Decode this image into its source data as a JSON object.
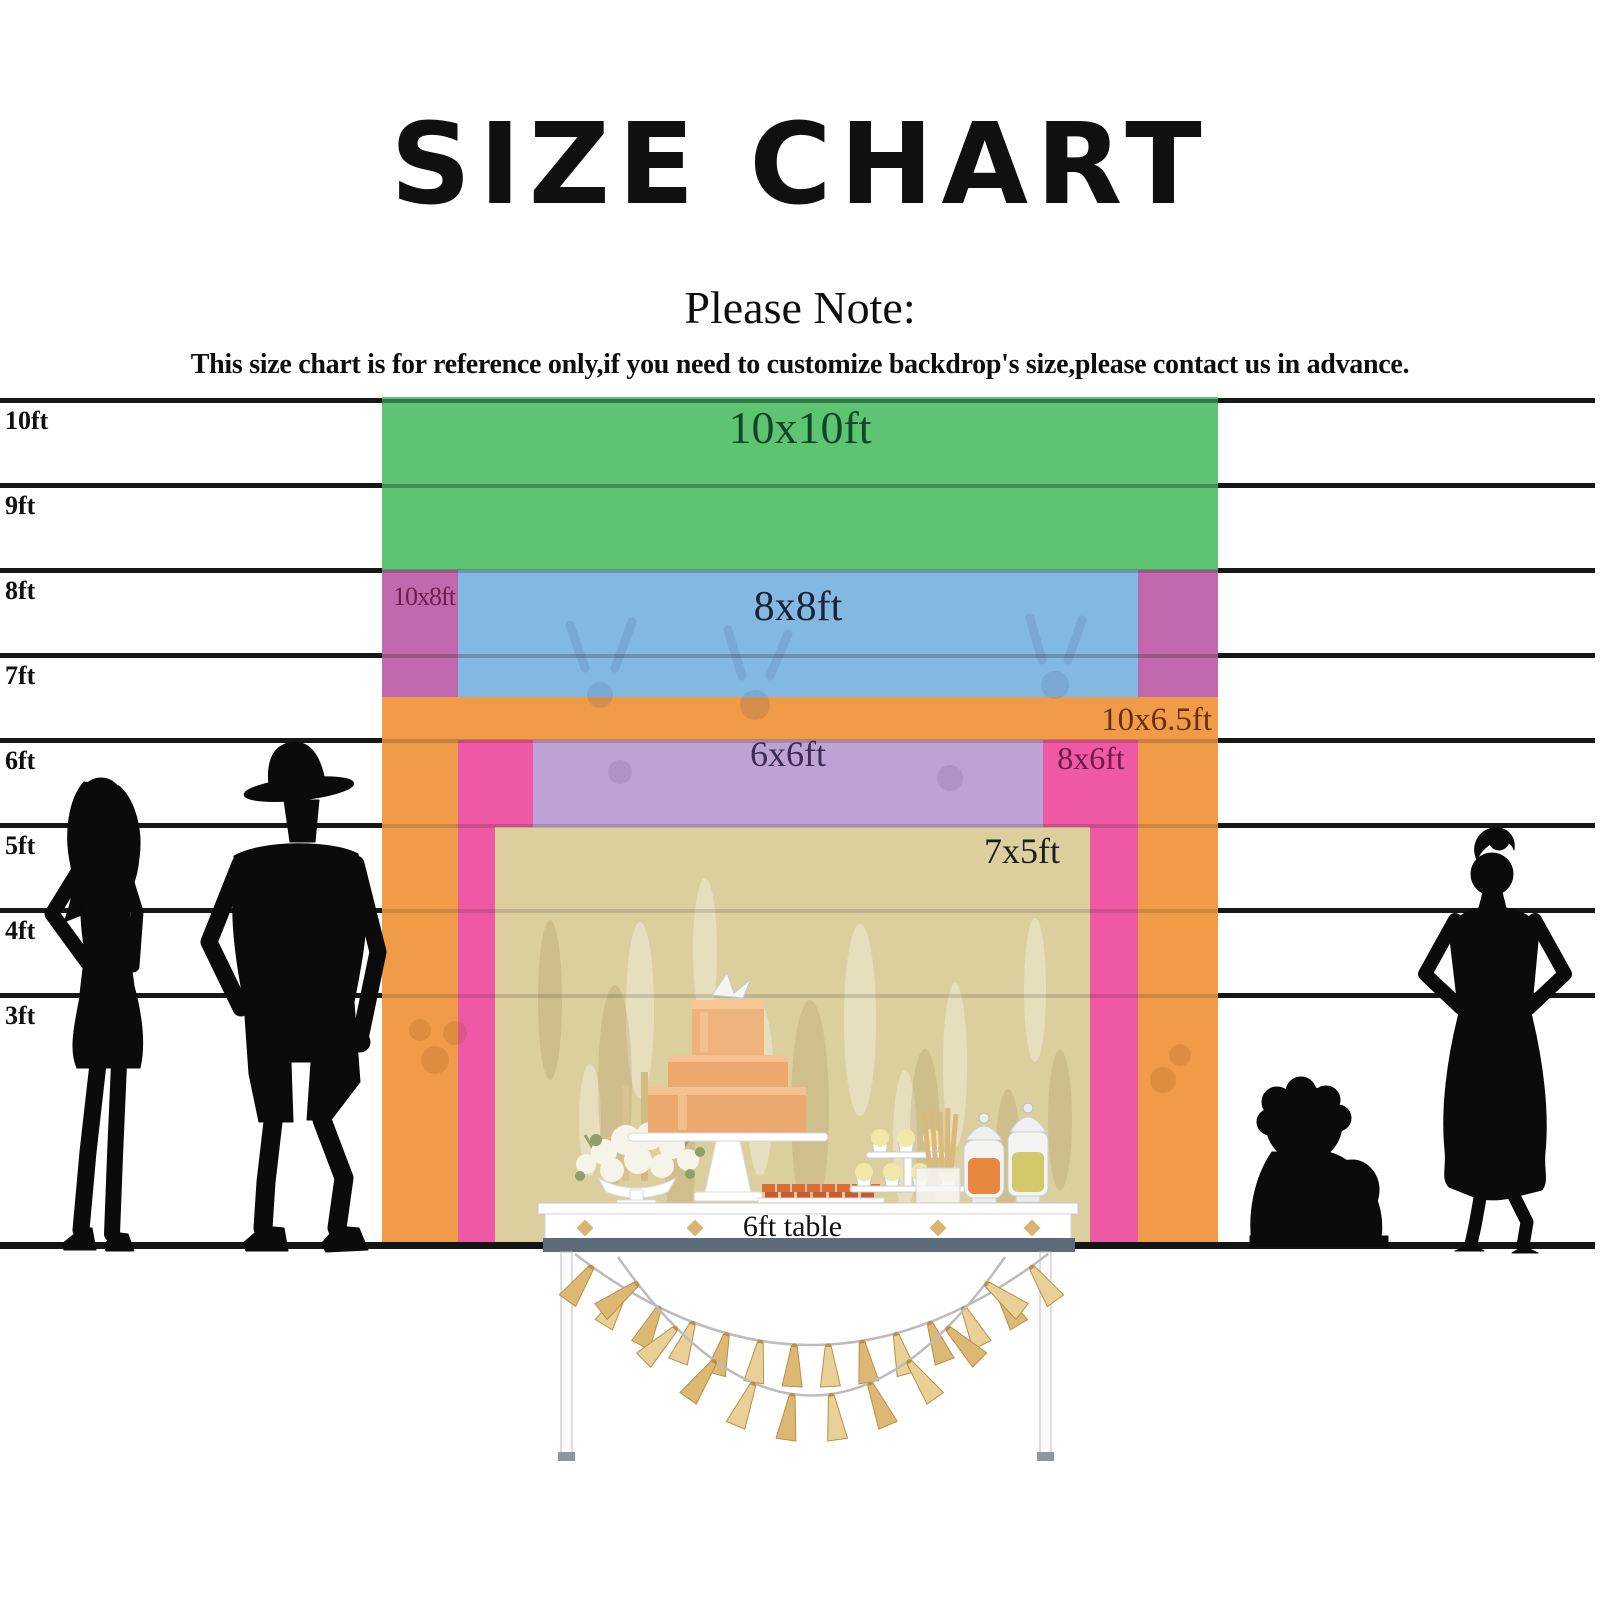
{
  "title": "SIZE CHART",
  "note_heading": "Please Note:",
  "note_body": "This size chart is for reference only,if you need to customize backdrop's size,please contact us in advance.",
  "ruler": {
    "labels": [
      "10ft",
      "9ft",
      "8ft",
      "7ft",
      "6ft",
      "5ft",
      "4ft",
      "3ft"
    ]
  },
  "sizes": {
    "s10x10": {
      "label": "10x10ft",
      "color": "#5ec474",
      "label_color": "#0d4a23"
    },
    "s10x8": {
      "label": "10x8ft",
      "color": "#c168ae",
      "label_color": "#6e1f4d"
    },
    "s8x8": {
      "label": "8x8ft",
      "color": "#83b8e3",
      "label_color": "#1b2335"
    },
    "s10x65": {
      "label": "10x6.5ft",
      "color": "#ef9b48",
      "label_color": "#6f2d10"
    },
    "s8x6": {
      "label": "8x6ft",
      "color": "#ee58a4",
      "label_color": "#701c4a"
    },
    "s6x6": {
      "label": "6x6ft",
      "color": "#bfa2d5",
      "label_color": "#3c2c54"
    },
    "s7x5": {
      "label": "7x5ft",
      "color": "#dccf9e",
      "label_color": "#1e1e1e"
    }
  },
  "table": {
    "label": "6ft table"
  },
  "garland": {
    "color": "#dcb873",
    "color_alt": "#e9d096",
    "stroke": "#b98f4a",
    "string": "#bcbcbc",
    "swags": [
      {
        "x1": 575,
        "y1": 1254,
        "cx": 811,
        "cy": 1436,
        "x2": 1048,
        "y2": 1254,
        "count": 14,
        "len": 42
      },
      {
        "x1": 618,
        "y1": 1257,
        "cx": 812,
        "cy": 1534,
        "x2": 1005,
        "y2": 1257,
        "count": 10,
        "len": 46
      }
    ]
  }
}
